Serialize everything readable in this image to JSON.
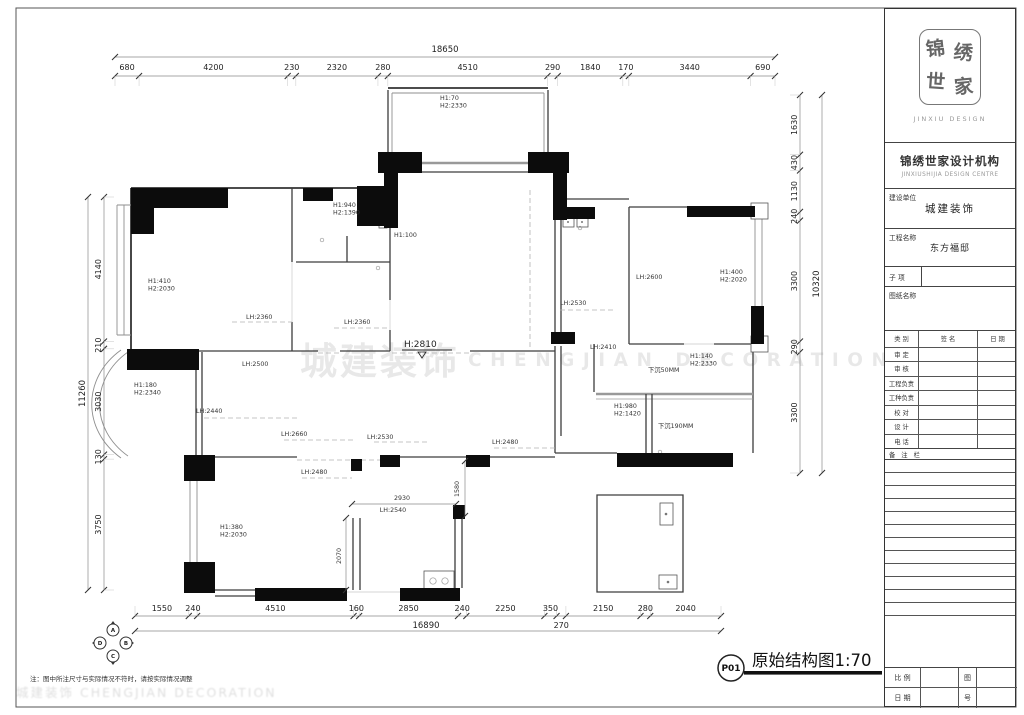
{
  "sheet": {
    "note": "注：图中所注尺寸与实际情况不符时，请按实际情况调整",
    "drawing_no": "P01",
    "drawing_title": "原始结构图1:70",
    "watermark_cn": "城建装饰",
    "watermark_en": "CHENGJIAN DECORATION",
    "watermark_corner": "城建装饰 CHENGJIAN DECORATION"
  },
  "title_block": {
    "logo_chars": [
      "锦",
      "绣",
      "世",
      "家"
    ],
    "logo_sub": "JINXIU DESIGN",
    "company_cn": "锦绣世家设计机构",
    "company_en": "JINXIUSHIJIA DESIGN CENTRE",
    "client_label": "建设单位",
    "client_value": "城建装饰",
    "project_label": "工程名称",
    "project_value": "东方福邸",
    "subitem_label": "子 项",
    "sheetname_label": "图纸名称",
    "sign_headers": [
      "类 别",
      "签 名",
      "日 期"
    ],
    "sign_rows": [
      "审 定",
      "审 核",
      "工程负责",
      "工种负责",
      "校 对",
      "设 计",
      "电 话"
    ],
    "remark_label": "备 注 栏",
    "scale_label": "比 例",
    "date_label": "日 期",
    "figno_top": "图",
    "figno_bottom": "号"
  },
  "plan": {
    "chains": {
      "top": {
        "total": "18650",
        "values": [
          680,
          4200,
          230,
          2320,
          280,
          4510,
          290,
          1840,
          170,
          3440,
          690
        ]
      },
      "left": {
        "total": "11260",
        "values": [
          4140,
          210,
          3030,
          130,
          3750
        ]
      },
      "right": {
        "total": "10320",
        "values": [
          1630,
          430,
          1130,
          240,
          3300,
          290,
          3300
        ]
      },
      "bottom": {
        "total": "16890",
        "values": [
          1550,
          240,
          4510,
          160,
          2850,
          240,
          2250,
          350,
          270,
          2150,
          280,
          2040
        ],
        "lower_tier_value": 270
      }
    },
    "inner_dims": [
      {
        "text": "2930",
        "x": 402,
        "y": 500,
        "rot": 0
      },
      {
        "text": "LH:2540",
        "x": 393,
        "y": 512,
        "rot": 0
      },
      {
        "text": "1580",
        "x": 459,
        "y": 489,
        "rot": -90
      },
      {
        "text": "2070",
        "x": 341,
        "y": 556,
        "rot": -90
      }
    ],
    "labels": [
      {
        "lines": [
          "H1:70",
          "H2:2330"
        ],
        "x": 440,
        "y": 100
      },
      {
        "lines": [
          "H1:940",
          "H2:1390"
        ],
        "x": 333,
        "y": 207
      },
      {
        "lines": [
          "H1:100"
        ],
        "x": 394,
        "y": 237
      },
      {
        "lines": [
          "H1:410",
          "H2:2030"
        ],
        "x": 148,
        "y": 283
      },
      {
        "lines": [
          "LH:2360"
        ],
        "x": 246,
        "y": 319
      },
      {
        "lines": [
          "LH:2360"
        ],
        "x": 344,
        "y": 324
      },
      {
        "lines": [
          "LH:2600"
        ],
        "x": 636,
        "y": 279
      },
      {
        "lines": [
          "H1:400",
          "H2:2020"
        ],
        "x": 720,
        "y": 274
      },
      {
        "lines": [
          "LH:2530"
        ],
        "x": 560,
        "y": 305
      },
      {
        "lines": [
          "LH:2410"
        ],
        "x": 590,
        "y": 349
      },
      {
        "lines": [
          "H1:140",
          "H2:2330"
        ],
        "x": 690,
        "y": 358
      },
      {
        "lines": [
          "下沉50MM"
        ],
        "x": 648,
        "y": 372
      },
      {
        "lines": [
          "H1:980",
          "H2:1420"
        ],
        "x": 614,
        "y": 408
      },
      {
        "lines": [
          "下沉190MM"
        ],
        "x": 658,
        "y": 428
      },
      {
        "lines": [
          "H1:180",
          "H2:2340"
        ],
        "x": 134,
        "y": 387
      },
      {
        "lines": [
          "LH:2500"
        ],
        "x": 242,
        "y": 366
      },
      {
        "lines": [
          "LH:2440"
        ],
        "x": 196,
        "y": 413
      },
      {
        "lines": [
          "LH:2660"
        ],
        "x": 281,
        "y": 436
      },
      {
        "lines": [
          "LH:2480"
        ],
        "x": 301,
        "y": 474
      },
      {
        "lines": [
          "LH:2530"
        ],
        "x": 367,
        "y": 439
      },
      {
        "lines": [
          "LH:2480"
        ],
        "x": 492,
        "y": 444
      },
      {
        "lines": [
          "H1:380",
          "H2:2030"
        ],
        "x": 220,
        "y": 529
      },
      {
        "lines": [
          "H:2810"
        ],
        "x": 404,
        "y": 347,
        "big": true
      }
    ],
    "elevation_letters": [
      "A",
      "B",
      "C",
      "D"
    ]
  }
}
